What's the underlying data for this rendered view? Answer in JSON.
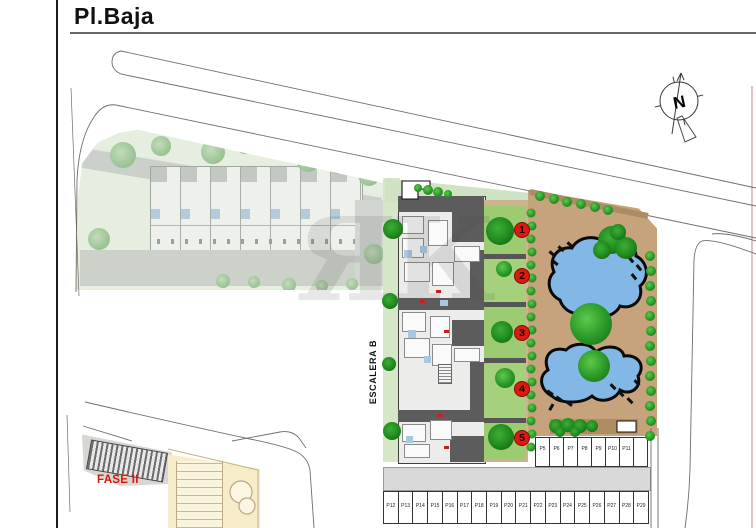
{
  "header": {
    "title": "Pl.Baja"
  },
  "plan": {
    "escalera_label": "ESCALERA B",
    "fase_label": "FASE II",
    "watermark": "ЯК",
    "compass_label": "N",
    "unit_markers": [
      "1",
      "2",
      "3",
      "4",
      "5"
    ],
    "parking": {
      "upper_row": [
        "P5",
        "P6",
        "P7",
        "P8",
        "P9",
        "P10",
        "P11"
      ],
      "lower_row": [
        "P12",
        "P13",
        "P14",
        "P15",
        "P16",
        "P17",
        "P18",
        "P19",
        "P20",
        "P21",
        "P22",
        "P23",
        "P24",
        "P25",
        "P26",
        "P27",
        "P28",
        "P29"
      ]
    },
    "colors": {
      "pool_water": "#82b7e6",
      "pool_deck_tan": "#c6a37d",
      "garden_green": "#9ccb72",
      "tree_green": "#2fa02c",
      "marker_red": "#e0190f",
      "fase_red": "#e0140e",
      "muted_site_green": "#e6eedf",
      "road_gray": "#d9d9d9"
    }
  }
}
